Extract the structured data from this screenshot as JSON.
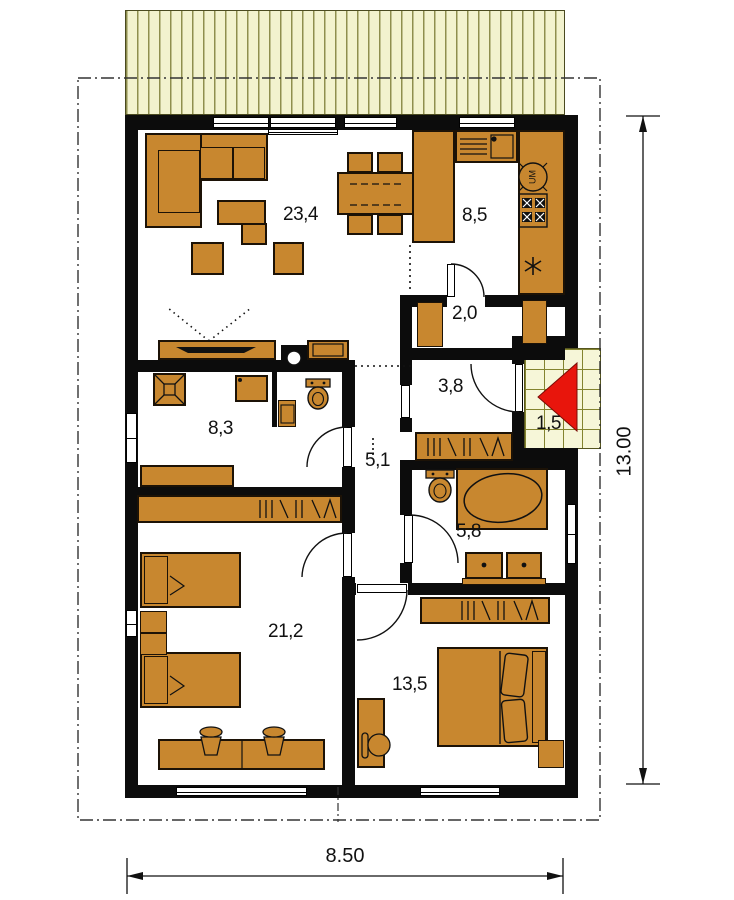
{
  "plan": {
    "type": "house-floor-plan",
    "rooms": {
      "living_room": {
        "area": "23,4"
      },
      "kitchen": {
        "area": "8,5"
      },
      "pantry": {
        "area": "2,0"
      },
      "entry_hall": {
        "area": "3,8"
      },
      "entry_porch": {
        "area": "1,5"
      },
      "bathroom_shower": {
        "area": "8,3"
      },
      "hallway": {
        "area": "5,1"
      },
      "bathroom_tub": {
        "area": "5,8"
      },
      "bedroom_children": {
        "area": "21,2"
      },
      "bedroom_master": {
        "area": "13,5"
      }
    },
    "dimensions": {
      "width_m": "8.50",
      "length_m": "13.00"
    },
    "appliance_labels": {
      "dishwasher": "UM"
    },
    "icons": {
      "entry-arrow-icon": "red triangle pointing left",
      "fridge-icon": "snowflake",
      "stove-icon": "4 burner squares",
      "shower-icon": "square with X",
      "dishwasher-icon": "circle labelled UM"
    },
    "colors": {
      "wall": "#0c0c0c",
      "furniture": "#c8872f",
      "roof_fill": "#f2f2ce",
      "tile_fill": "#f6f6d8",
      "entry_arrow": "#e8150c"
    }
  }
}
